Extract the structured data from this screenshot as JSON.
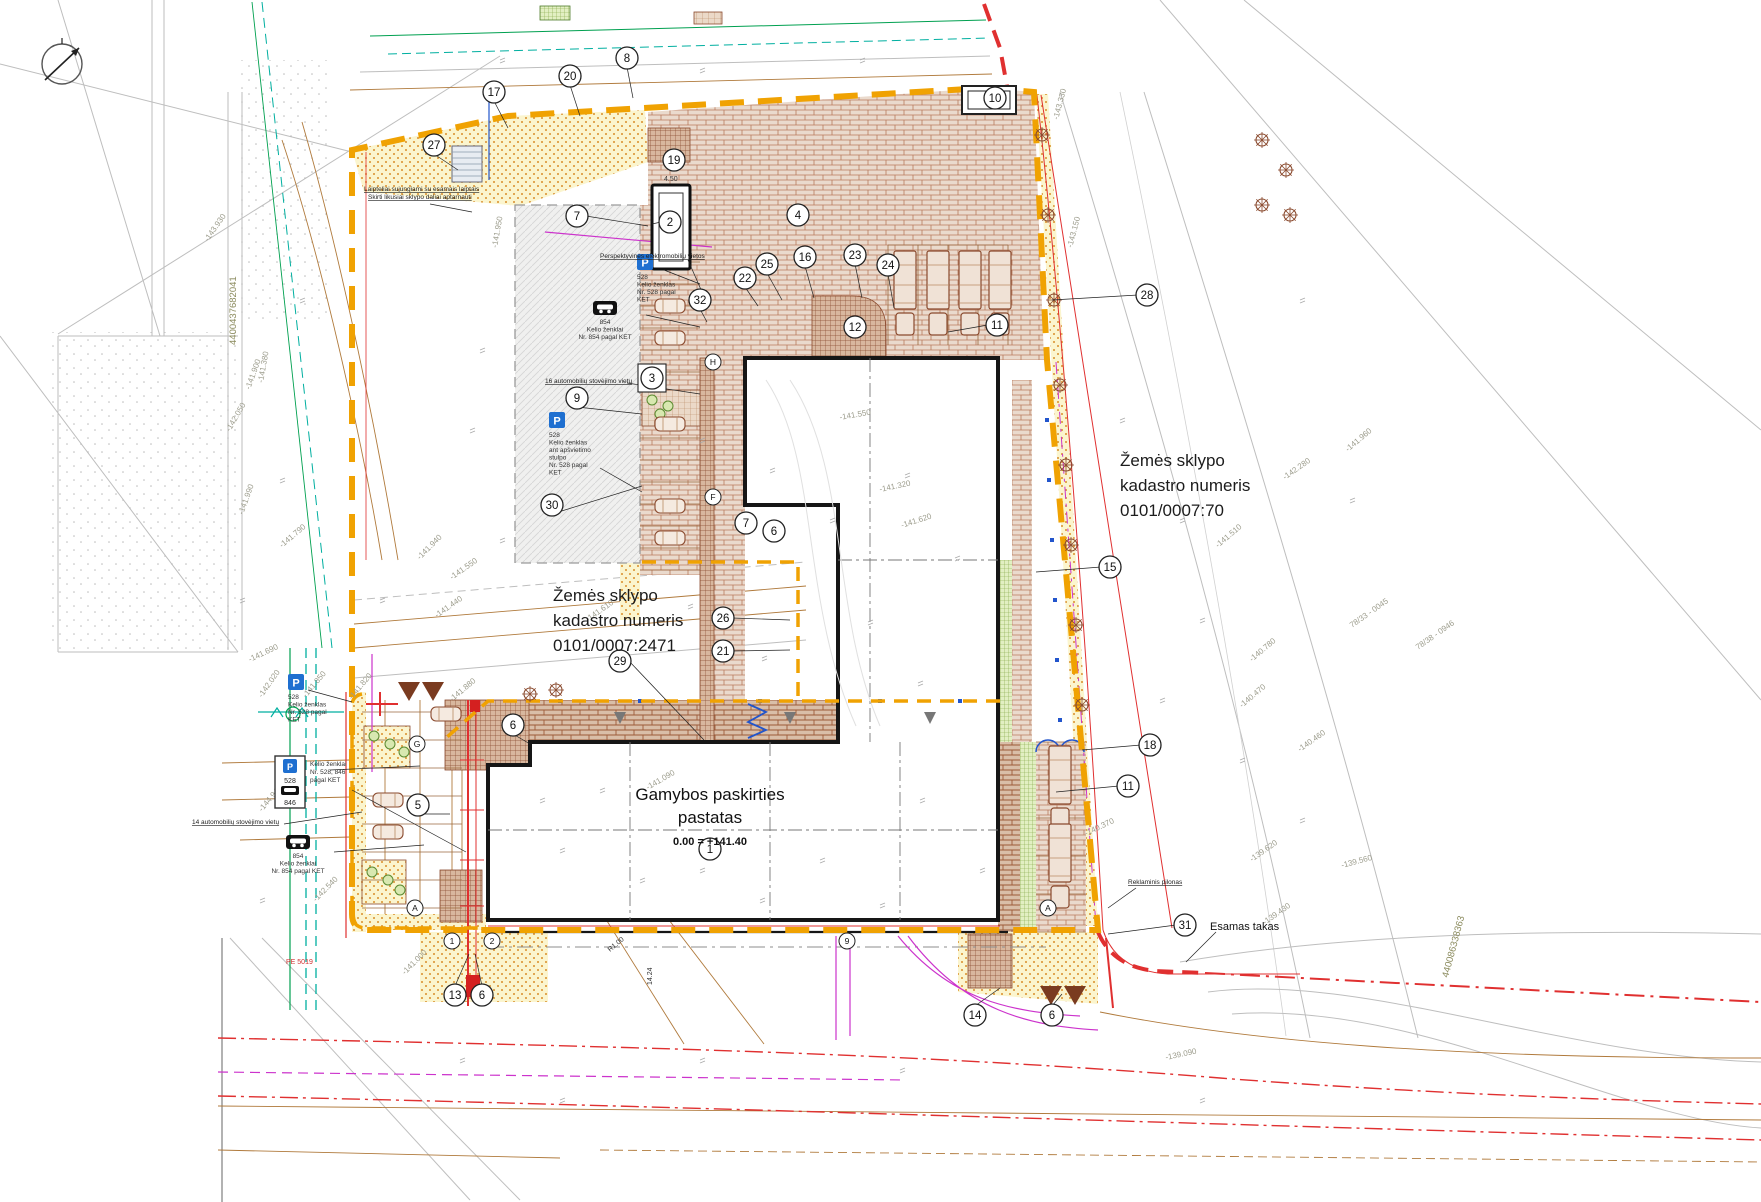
{
  "drawing": {
    "type": "site-plan",
    "parcel_right": {
      "line1": "Žemės sklypo",
      "line2": "kadastro numeris",
      "line3": "0101/0007:70"
    },
    "parcel_center": {
      "line1": "Žemės sklypo",
      "line2": "kadastro numeris",
      "line3": "0101/0007:2471"
    },
    "building": {
      "line1": "Gamybos paskirties",
      "line2": "pastatas",
      "level": "0.00 = +141.40",
      "callout": "1"
    },
    "esamas_takas": "Esamas takas"
  },
  "colors": {
    "boundary_orange": "#F0A202",
    "red": "#E03030",
    "magenta": "#CC33CC",
    "teal": "#00AFA0",
    "green": "#00A050",
    "blue": "#2255CC",
    "brick": "#A65A3A",
    "sign_blue": "#1E6FD0",
    "survey_gray": "#BEBEBE",
    "topo_text": "#9C9C8C"
  },
  "notes": [
    {
      "t": "Perspektyvinės elektromobilių vietos",
      "x": 600,
      "y": 258,
      "s": 6.5,
      "u": 1,
      "a": "start"
    },
    {
      "t": "Laipteliai sujungiami su esamais laiptais",
      "x": 364,
      "y": 191,
      "s": 6.5,
      "u": 1,
      "a": "start"
    },
    {
      "t": "Skirti likusiai sklypo daliai aptarnauti",
      "x": 368,
      "y": 199,
      "s": 6.5,
      "u": 1,
      "a": "start"
    },
    {
      "t": "16 automobilių stovėjimo vietų",
      "x": 545,
      "y": 383,
      "s": 6.5,
      "u": 1,
      "a": "start"
    },
    {
      "t": "14 automobilių stovėjimo vietų",
      "x": 192,
      "y": 824,
      "s": 6.5,
      "u": 1,
      "a": "start"
    },
    {
      "t": "Reklaminis pilonas",
      "x": 1128,
      "y": 884,
      "s": 6.5,
      "u": 1,
      "a": "start"
    },
    {
      "t": "PE 5019",
      "x": 286,
      "y": 964,
      "s": 7,
      "c": "#D03030",
      "a": "start"
    },
    {
      "t": "4.50",
      "x": 664,
      "y": 181,
      "s": 7,
      "c": "#333",
      "a": "start"
    },
    {
      "t": "R1.00",
      "x": 610,
      "y": 952,
      "s": 7,
      "c": "#333",
      "r": -40
    },
    {
      "t": "14.24",
      "x": 652,
      "y": 985,
      "s": 7,
      "c": "#333",
      "r": -90
    }
  ],
  "topo_labels": [
    [
      "-141.550",
      452,
      580,
      -35
    ],
    [
      "-141.440",
      437,
      618,
      -35
    ],
    [
      "-141.610",
      588,
      622,
      -35
    ],
    [
      "-142.050",
      230,
      432,
      -60
    ],
    [
      "-141.990",
      243,
      515,
      -70
    ],
    [
      "-141.900",
      250,
      390,
      -70
    ],
    [
      "-141.380",
      263,
      383,
      -80
    ],
    [
      "-143.930",
      208,
      242,
      -55
    ],
    [
      "-142.540",
      316,
      902,
      -45
    ],
    [
      "-144.940",
      262,
      812,
      -50
    ],
    [
      "-141.850",
      306,
      698,
      -50
    ],
    [
      "-141.820",
      352,
      700,
      -50
    ],
    [
      "-141.880",
      452,
      702,
      -40
    ],
    [
      "-142.020",
      262,
      698,
      -55
    ],
    [
      "-141.790",
      282,
      548,
      -40
    ],
    [
      "-141.690",
      250,
      662,
      -25
    ],
    [
      "-141.090",
      648,
      790,
      -30
    ],
    [
      "-141.000",
      405,
      975,
      -45
    ],
    [
      "-141.320",
      880,
      492,
      -12
    ],
    [
      "-141.620",
      902,
      528,
      -18
    ],
    [
      "-141.550",
      840,
      420,
      -10
    ],
    [
      "-142.280",
      1285,
      480,
      -35
    ],
    [
      "-141.960",
      1348,
      452,
      -40
    ],
    [
      "-141.510",
      1218,
      548,
      -40
    ],
    [
      "-140.780",
      1252,
      662,
      -40
    ],
    [
      "-140.470",
      1242,
      708,
      -40
    ],
    [
      "-140.460",
      1300,
      752,
      -35
    ],
    [
      "-139.620",
      1252,
      862,
      -35
    ],
    [
      "-139.560",
      1342,
      868,
      -15
    ],
    [
      "-139.430",
      1265,
      925,
      -35
    ],
    [
      "-140.370",
      1086,
      836,
      -25
    ],
    [
      "-143.150",
      1072,
      248,
      -75
    ],
    [
      "-143.330",
      1058,
      120,
      -75
    ],
    [
      "78/33 - 0045",
      1352,
      628,
      -35
    ],
    [
      "78/38 - 0946",
      1418,
      650,
      -35
    ],
    [
      "-141.950",
      497,
      248,
      -80
    ],
    [
      "-141.940",
      420,
      560,
      -45
    ],
    [
      "-139.090",
      1166,
      1060,
      -12
    ]
  ],
  "cad_ids": [
    [
      "4400437682041",
      236,
      345,
      -90
    ],
    [
      "440086338363",
      1448,
      978,
      -75
    ]
  ],
  "signs": [
    {
      "type": "p",
      "x": 645,
      "y": 262,
      "lines": [
        "528",
        "Kelio ženklas",
        "Nr. 528 pagal",
        "KET"
      ]
    },
    {
      "type": "p",
      "x": 557,
      "y": 420,
      "lines": [
        "528",
        "Kelio ženklas",
        "ant apšvietimo",
        "stulpo",
        "Nr. 528 pagal",
        "KET"
      ]
    },
    {
      "type": "p",
      "x": 296,
      "y": 682,
      "lines": [
        "528",
        "Kelio ženklas",
        "Nr. 528 pagal",
        "KET"
      ]
    },
    {
      "type": "pbox",
      "x": 290,
      "y": 782,
      "labels": [
        "528",
        "846"
      ],
      "side": [
        "Kelio ženklai",
        "Nr. 528, 846",
        "pagal KET"
      ]
    },
    {
      "type": "tow",
      "x": 605,
      "y": 308,
      "lines": [
        "854",
        "Kelio ženklai",
        "Nr. 854 pagal KET"
      ]
    },
    {
      "type": "tow",
      "x": 298,
      "y": 842,
      "lines": [
        "854",
        "Kelio ženklai",
        "Nr. 854 pagal KET"
      ]
    }
  ],
  "callouts": [
    [
      "8",
      627,
      58,
      0
    ],
    [
      "20",
      570,
      76,
      0
    ],
    [
      "17",
      494,
      92,
      0
    ],
    [
      "27",
      434,
      145,
      0
    ],
    [
      "19",
      674,
      160,
      0
    ],
    [
      "10",
      995,
      98,
      0
    ],
    [
      "7",
      577,
      216,
      0
    ],
    [
      "2",
      670,
      222,
      0
    ],
    [
      "4",
      798,
      215,
      0
    ],
    [
      "25",
      767,
      264,
      0
    ],
    [
      "16",
      805,
      257,
      0
    ],
    [
      "23",
      855,
      255,
      0
    ],
    [
      "24",
      888,
      265,
      0
    ],
    [
      "22",
      745,
      278,
      0
    ],
    [
      "32",
      700,
      300,
      0
    ],
    [
      "12",
      855,
      327,
      0
    ],
    [
      "11",
      997,
      325,
      0
    ],
    [
      "28",
      1147,
      295,
      0
    ],
    [
      "3",
      652,
      378,
      1
    ],
    [
      "9",
      577,
      398,
      0
    ],
    [
      "30",
      552,
      505,
      0
    ],
    [
      "7",
      746,
      523,
      0
    ],
    [
      "6",
      774,
      531,
      0
    ],
    [
      "15",
      1110,
      567,
      0
    ],
    [
      "26",
      723,
      618,
      0
    ],
    [
      "21",
      723,
      651,
      0
    ],
    [
      "29",
      620,
      661,
      0
    ],
    [
      "6",
      513,
      725,
      0
    ],
    [
      "5",
      418,
      805,
      0
    ],
    [
      "18",
      1150,
      745,
      0
    ],
    [
      "11",
      1128,
      786,
      0
    ],
    [
      "31",
      1185,
      925,
      0
    ],
    [
      "13",
      455,
      995,
      0
    ],
    [
      "6",
      482,
      995,
      0
    ],
    [
      "14",
      975,
      1015,
      0
    ],
    [
      "6",
      1052,
      1015,
      0
    ],
    [
      "1",
      710,
      849,
      0
    ]
  ],
  "axis_bubbles": [
    [
      "A",
      415,
      908
    ],
    [
      "A",
      1048,
      908
    ],
    [
      "G",
      417,
      744
    ],
    [
      "F",
      713,
      497
    ],
    [
      "H",
      713,
      362
    ],
    [
      "1",
      452,
      941
    ],
    [
      "2",
      492,
      941
    ],
    [
      "9",
      847,
      941
    ]
  ],
  "leaders": [
    [
      494,
      101,
      508,
      128
    ],
    [
      570,
      85,
      580,
      116
    ],
    [
      627,
      67,
      633,
      98
    ],
    [
      434,
      154,
      458,
      170
    ],
    [
      674,
      169,
      670,
      150
    ],
    [
      586,
      216,
      648,
      226
    ],
    [
      661,
      222,
      652,
      224
    ],
    [
      745,
      287,
      758,
      306
    ],
    [
      767,
      273,
      782,
      300
    ],
    [
      805,
      266,
      814,
      298
    ],
    [
      855,
      264,
      862,
      298
    ],
    [
      888,
      274,
      894,
      308
    ],
    [
      700,
      309,
      707,
      322
    ],
    [
      988,
      325,
      948,
      332
    ],
    [
      1138,
      295,
      1052,
      300
    ],
    [
      577,
      407,
      642,
      414
    ],
    [
      552,
      514,
      642,
      486
    ],
    [
      1101,
      567,
      1036,
      572
    ],
    [
      732,
      618,
      790,
      620
    ],
    [
      732,
      651,
      790,
      650
    ],
    [
      629,
      661,
      704,
      740
    ],
    [
      513,
      734,
      530,
      744
    ],
    [
      418,
      814,
      450,
      814
    ],
    [
      1141,
      745,
      1082,
      750
    ],
    [
      1119,
      786,
      1056,
      792
    ],
    [
      1176,
      925,
      1108,
      934
    ],
    [
      455,
      986,
      469,
      954
    ],
    [
      482,
      986,
      475,
      954
    ],
    [
      975,
      1006,
      1000,
      988
    ],
    [
      1052,
      1006,
      1062,
      994
    ],
    [
      430,
      204,
      472,
      212
    ],
    [
      688,
      260,
      702,
      292
    ],
    [
      627,
      383,
      700,
      394
    ],
    [
      284,
      824,
      362,
      812
    ],
    [
      352,
      790,
      466,
      852
    ],
    [
      600,
      468,
      642,
      492
    ],
    [
      1136,
      888,
      1108,
      908
    ],
    [
      1216,
      932,
      1186,
      962
    ],
    [
      646,
      315,
      700,
      327
    ],
    [
      334,
      852,
      424,
      845
    ],
    [
      308,
      690,
      352,
      702
    ],
    [
      664,
      270,
      700,
      284
    ],
    [
      330,
      770,
      420,
      766
    ]
  ],
  "ticks": [
    [
      700,
      440
    ],
    [
      770,
      470
    ],
    [
      830,
      520
    ],
    [
      905,
      475
    ],
    [
      955,
      558
    ],
    [
      868,
      622
    ],
    [
      918,
      683
    ],
    [
      762,
      658
    ],
    [
      688,
      606
    ],
    [
      600,
      790
    ],
    [
      560,
      850
    ],
    [
      700,
      870
    ],
    [
      820,
      860
    ],
    [
      920,
      800
    ],
    [
      980,
      870
    ],
    [
      540,
      800
    ],
    [
      640,
      880
    ],
    [
      760,
      900
    ],
    [
      880,
      905
    ],
    [
      480,
      350
    ],
    [
      470,
      430
    ],
    [
      500,
      540
    ],
    [
      380,
      600
    ],
    [
      1120,
      420
    ],
    [
      1180,
      520
    ],
    [
      1200,
      620
    ],
    [
      1160,
      700
    ],
    [
      1240,
      760
    ],
    [
      1300,
      820
    ],
    [
      500,
      60
    ],
    [
      700,
      70
    ],
    [
      860,
      60
    ],
    [
      300,
      300
    ],
    [
      280,
      480
    ],
    [
      1300,
      300
    ],
    [
      1350,
      500
    ],
    [
      460,
      1060
    ],
    [
      700,
      1060
    ],
    [
      560,
      1100
    ],
    [
      900,
      1070
    ],
    [
      1200,
      1100
    ],
    [
      260,
      900
    ],
    [
      240,
      600
    ]
  ],
  "trees_boundary": [
    [
      1042,
      135
    ],
    [
      1048,
      215
    ],
    [
      1054,
      300
    ],
    [
      1060,
      385
    ],
    [
      1066,
      465
    ],
    [
      1071,
      545
    ],
    [
      1076,
      625
    ],
    [
      1082,
      705
    ],
    [
      1262,
      140
    ],
    [
      1286,
      170
    ],
    [
      1262,
      205
    ],
    [
      1290,
      215
    ],
    [
      530,
      694
    ],
    [
      556,
      690
    ]
  ],
  "trees_beds": [
    [
      374,
      736
    ],
    [
      390,
      744
    ],
    [
      404,
      752
    ],
    [
      372,
      872
    ],
    [
      388,
      880
    ],
    [
      400,
      890
    ],
    [
      652,
      400
    ],
    [
      668,
      406
    ],
    [
      660,
      414
    ]
  ],
  "trucks": [
    [
      905,
      295
    ],
    [
      938,
      295
    ],
    [
      970,
      295
    ],
    [
      1000,
      295
    ],
    [
      1060,
      790
    ],
    [
      1060,
      868
    ]
  ],
  "cars": [
    [
      670,
      306
    ],
    [
      670,
      338
    ],
    [
      670,
      424
    ],
    [
      670,
      506
    ],
    [
      670,
      538
    ],
    [
      388,
      800
    ],
    [
      388,
      832
    ],
    [
      446,
      714
    ]
  ],
  "warn_triangles": [
    [
      398,
      682
    ],
    [
      422,
      682
    ],
    [
      1040,
      986
    ],
    [
      1064,
      986
    ]
  ]
}
